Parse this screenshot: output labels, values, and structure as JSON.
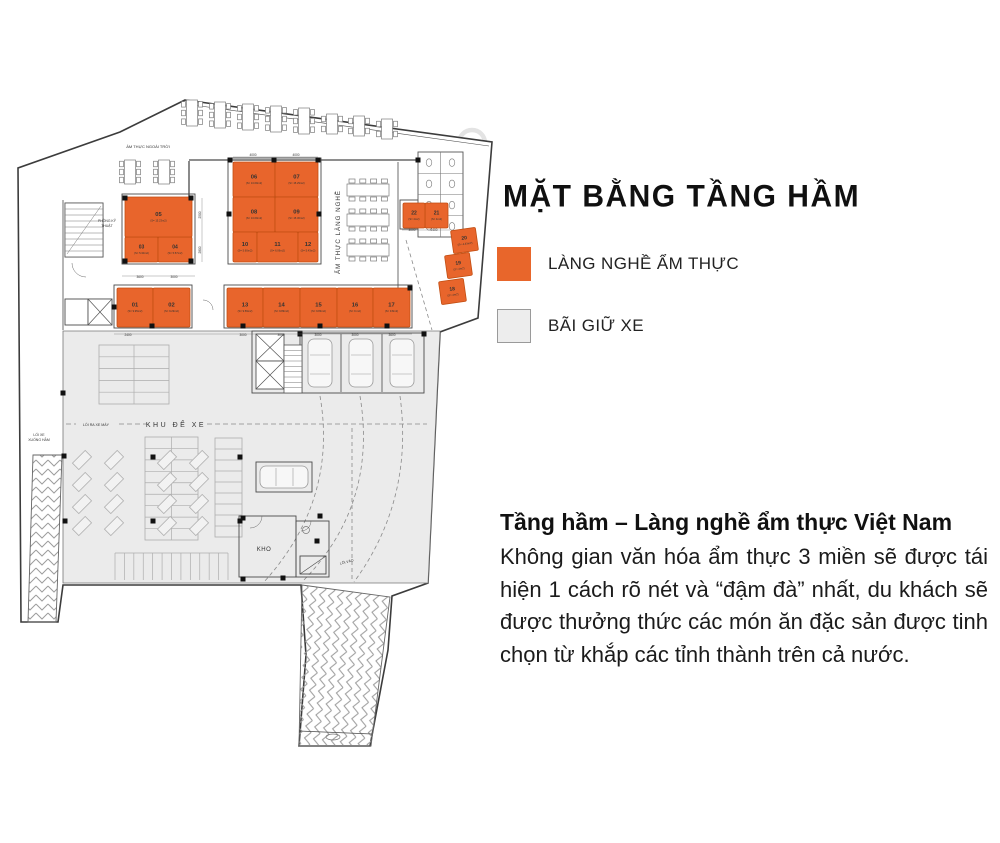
{
  "title": "MẶT BẰNG TẦNG HẦM",
  "legend": {
    "items": [
      {
        "label": "LÀNG NGHỀ ẨM THỰC",
        "color": "#E8662B",
        "border": "#E8662B"
      },
      {
        "label": "BÃI GIỮ XE",
        "color": "#EDEDED",
        "border": "#9A9A9A"
      }
    ]
  },
  "description": {
    "heading": "Tầng hầm – Làng nghề ẩm thực Việt Nam",
    "body": "Không gian văn hóa ẩm thực 3 miền sẽ được tái hiện 1 cách rõ nét và “đậm đà” nhất, du khách sẽ được thưởng thức các món ăn đặc sản được tinh chọn từ khắp các tỉnh thành trên cả nước."
  },
  "plan": {
    "colors": {
      "unit": "#E8652C",
      "unitBorder": "#C24E12",
      "unitText": "#3d1500",
      "parking": "#EBEBEB",
      "line": "#3c3c3c",
      "thin": "#7d7d7d",
      "grid": "#ADADAD",
      "dash": "#8a8a8a",
      "watermark": "#E3E3E3"
    },
    "outline": "185,100 492,142 478,318 440,332 428,583 392,596 388,650 370,746 299,746 306,655 301,585 63,585 58,622 21,622 18,168 120,132",
    "parking": "63,331 440,331 428,583 63,583",
    "ramps": [
      {
        "name": "ramp-down-left",
        "pts": "33,455 62,455 56,622 28,622",
        "pattern": "chevV"
      },
      {
        "name": "ramp-entrance",
        "pts": "302,585 390,597 371,746 299,746",
        "pattern": "chevR"
      }
    ],
    "watermarks": [
      [
        472,
        143,
        13
      ],
      [
        590,
        131,
        13
      ]
    ],
    "lines": [
      [
        186,
        104,
        489,
        146,
        0.6
      ],
      [
        189,
        160,
        418,
        160,
        1.3
      ],
      [
        189,
        161,
        189,
        197,
        1.3
      ],
      [
        398,
        162,
        398,
        288,
        0.8
      ],
      [
        63,
        200,
        63,
        330,
        0.8
      ],
      [
        341,
        334,
        341,
        392,
        0.8
      ],
      [
        382,
        334,
        382,
        392,
        0.8
      ],
      [
        299,
        731,
        372,
        734,
        0.8
      ],
      [
        300,
        574,
        326,
        556,
        0.6
      ]
    ],
    "segline": {
      "y": 424,
      "segs": [
        [
          66,
          76
        ],
        [
          119,
          147
        ],
        [
          207,
          427
        ]
      ]
    },
    "grids": [
      {
        "x": 99,
        "y": 345,
        "w": 70,
        "h": 59,
        "rows": 5,
        "cols": 2
      },
      {
        "x": 145,
        "y": 437,
        "w": 53,
        "h": 103,
        "rows": 9,
        "cols": 2
      },
      {
        "x": 215,
        "y": 438,
        "w": 27,
        "h": 99,
        "rows": 9,
        "cols": 1
      },
      {
        "x": 115,
        "y": 553,
        "w": 113,
        "h": 27,
        "comb": 12
      }
    ],
    "diamond_xs": [
      82,
      114,
      167,
      199
    ],
    "diamond_ys": [
      460,
      482,
      504,
      526
    ],
    "dashes": [
      "M352,428 L352,582",
      "M320,396 Q338,500 264,582",
      "M360,396 Q378,505 302,582",
      "M400,396 Q414,500 354,582",
      "M406,240 L432,330"
    ],
    "rooms": [
      {
        "x": 122,
        "y": 194,
        "w": 73,
        "h": 70
      },
      {
        "x": 228,
        "y": 158,
        "w": 93,
        "h": 106
      },
      {
        "x": 114,
        "y": 285,
        "w": 78,
        "h": 43
      },
      {
        "x": 224,
        "y": 285,
        "w": 188,
        "h": 43
      },
      {
        "x": 400,
        "y": 200,
        "w": 50,
        "h": 29
      },
      {
        "x": 252,
        "y": 331,
        "w": 50,
        "h": 62
      },
      {
        "x": 239,
        "y": 516,
        "w": 57,
        "h": 61
      },
      {
        "x": 296,
        "y": 521,
        "w": 33,
        "h": 56
      },
      {
        "x": 65,
        "y": 203,
        "w": 38,
        "h": 54
      },
      {
        "x": 65,
        "y": 299,
        "w": 23,
        "h": 26
      },
      {
        "x": 88,
        "y": 299,
        "w": 24,
        "h": 26
      },
      {
        "x": 300,
        "y": 333,
        "w": 124,
        "h": 60
      },
      {
        "x": 256,
        "y": 462,
        "w": 56,
        "h": 30
      },
      {
        "x": 300,
        "y": 556,
        "w": 26,
        "h": 18
      }
    ],
    "elevators": [
      {
        "x": 88,
        "y": 299,
        "w": 24,
        "h": 26
      },
      {
        "x": 256,
        "y": 334,
        "w": 28,
        "h": 27
      },
      {
        "x": 256,
        "y": 361,
        "w": 28,
        "h": 28
      }
    ],
    "stairs": [
      {
        "x": 65,
        "y": 203,
        "w": 38,
        "h": 54,
        "n": 9,
        "diag": 1
      },
      {
        "x": 284,
        "y": 345,
        "w": 18,
        "h": 48,
        "n": 9
      }
    ],
    "cars": [
      {
        "x": 320,
        "y": 363
      },
      {
        "x": 361,
        "y": 363
      },
      {
        "x": 402,
        "y": 363
      },
      {
        "x": 284,
        "y": 477,
        "o": "h"
      }
    ],
    "tables": [
      {
        "x": 192,
        "y": 113
      },
      {
        "x": 220,
        "y": 115
      },
      {
        "x": 248,
        "y": 117
      },
      {
        "x": 276,
        "y": 119
      },
      {
        "x": 304,
        "y": 121
      },
      {
        "x": 332,
        "y": 124,
        "hh": 20,
        "n": 2
      },
      {
        "x": 359,
        "y": 126,
        "hh": 20,
        "n": 2
      },
      {
        "x": 387,
        "y": 129,
        "hh": 20,
        "n": 2
      },
      {
        "x": 130,
        "y": 172,
        "hh": 24
      },
      {
        "x": 164,
        "y": 172,
        "hh": 24
      },
      {
        "x": 368,
        "y": 190,
        "o": "h"
      },
      {
        "x": 368,
        "y": 220,
        "o": "h"
      },
      {
        "x": 368,
        "y": 250,
        "o": "h"
      }
    ],
    "wc": {
      "x": 418,
      "y": 152,
      "w": 45,
      "h": 85,
      "rows": 4
    },
    "fixtures": {
      "circles": [
        [
          306,
          530,
          3.5
        ],
        [
          333,
          737,
          7,
          3
        ]
      ]
    },
    "arcs": [
      "M72,263 a14,14 0 0 0 14,14",
      "M262,516 a12,12 0 0 1 -12,12",
      "M203,300 a10,10 0 0 1 10,10",
      "M311,521 a10,10 0 0 1 -10,10"
    ],
    "units": [
      {
        "id": "01",
        "area": "(S= 9.95m2)",
        "x": 117,
        "y": 288,
        "w": 36,
        "h": 39
      },
      {
        "id": "02",
        "area": "(S= 9.29m2)",
        "x": 153,
        "y": 288,
        "w": 37,
        "h": 39
      },
      {
        "id": "03",
        "area": "(S= 5.30m2)",
        "x": 125,
        "y": 237,
        "w": 33,
        "h": 25
      },
      {
        "id": "04",
        "area": "(S= 5.57m2)",
        "x": 158,
        "y": 237,
        "w": 34,
        "h": 25
      },
      {
        "id": "05",
        "area": "(S= 15.23m2)",
        "x": 125,
        "y": 197,
        "w": 67,
        "h": 40
      },
      {
        "id": "06",
        "area": "(S= 13.69m2)",
        "x": 233,
        "y": 162,
        "w": 42,
        "h": 35
      },
      {
        "id": "07",
        "area": "(S= 15.29m2)",
        "x": 275,
        "y": 162,
        "w": 43,
        "h": 35
      },
      {
        "id": "08",
        "area": "(S= 13.69m2)",
        "x": 233,
        "y": 197,
        "w": 42,
        "h": 35
      },
      {
        "id": "09",
        "area": "(S= 15.30m2)",
        "x": 275,
        "y": 197,
        "w": 43,
        "h": 35
      },
      {
        "id": "10",
        "area": "(S= 5.60m2)",
        "x": 233,
        "y": 232,
        "w": 24,
        "h": 30
      },
      {
        "id": "11",
        "area": "(S= 6.06m2)",
        "x": 257,
        "y": 232,
        "w": 41,
        "h": 30
      },
      {
        "id": "12",
        "area": "(S= 5.43m2)",
        "x": 298,
        "y": 232,
        "w": 20,
        "h": 30
      },
      {
        "id": "13",
        "area": "(S= 9.59m2)",
        "x": 227,
        "y": 288,
        "w": 36,
        "h": 39
      },
      {
        "id": "14",
        "area": "(S= 9.89m2)",
        "x": 263,
        "y": 288,
        "w": 37,
        "h": 39
      },
      {
        "id": "15",
        "area": "(S= 9.83m2)",
        "x": 300,
        "y": 288,
        "w": 37,
        "h": 39
      },
      {
        "id": "16",
        "area": "(S= 9 m2)",
        "x": 337,
        "y": 288,
        "w": 36,
        "h": 39
      },
      {
        "id": "17",
        "area": "(S= 9.8m2)",
        "x": 373,
        "y": 288,
        "w": 37,
        "h": 39
      },
      {
        "id": "18",
        "area": "(S= 4m2)",
        "x": 440,
        "y": 280,
        "w": 25,
        "h": 23,
        "rot": -8
      },
      {
        "id": "19",
        "area": "(S= 4m2)",
        "x": 446,
        "y": 254,
        "w": 25,
        "h": 23,
        "rot": -8
      },
      {
        "id": "20",
        "area": "(S= 4.43m2)",
        "x": 452,
        "y": 229,
        "w": 25,
        "h": 23,
        "rot": -8
      },
      {
        "id": "21",
        "area": "(S= 4m2)",
        "x": 425,
        "y": 203,
        "w": 23,
        "h": 25
      },
      {
        "id": "22",
        "area": "(S= 4m2)",
        "x": 403,
        "y": 203,
        "w": 22,
        "h": 25
      }
    ],
    "labels": [
      {
        "t": "ẨM THỰC NGOÀI TRỜI",
        "x": 148,
        "y": 148,
        "s": 4
      },
      {
        "t": "PHÒNG KỸ",
        "x": 107,
        "y": 222,
        "s": 3.4
      },
      {
        "t": "THUẬT",
        "x": 107,
        "y": 227,
        "s": 3.4
      },
      {
        "t": "ẨM THỰC LÀNG NGHỀ",
        "x": 340,
        "y": 232,
        "s": 6.2,
        "r": -90,
        "ls": 1
      },
      {
        "t": "KHU ĐỂ XE",
        "x": 176,
        "y": 427,
        "s": 7,
        "ls": 2.5
      },
      {
        "t": "LỐI RA XE MÁY",
        "x": 96,
        "y": 426,
        "s": 3.6
      },
      {
        "t": "LỐI XE",
        "x": 39,
        "y": 436,
        "s": 3.5
      },
      {
        "t": "XUỐNG HẦM",
        "x": 39,
        "y": 441,
        "s": 3.5
      },
      {
        "t": "KHO",
        "x": 264,
        "y": 551,
        "s": 6,
        "ls": 0.5
      },
      {
        "t": "LỐI VÀO",
        "x": 347,
        "y": 563,
        "s": 3.5,
        "r": -15
      }
    ],
    "dims": [
      [
        "4000",
        253,
        156
      ],
      [
        "4000",
        296,
        156
      ],
      [
        "3600",
        140,
        278
      ],
      [
        "3000",
        174,
        278
      ],
      [
        "3000",
        412,
        231
      ],
      [
        "2400",
        434,
        231
      ],
      [
        "2400",
        128,
        336
      ],
      [
        "3000",
        243,
        336
      ],
      [
        "3000",
        281,
        336
      ],
      [
        "3000",
        318,
        336
      ],
      [
        "3000",
        355,
        336
      ],
      [
        "3600",
        392,
        336
      ],
      [
        "2500",
        201,
        215,
        -90
      ],
      [
        "2800",
        201,
        250,
        -90
      ]
    ],
    "dimLines": [
      [
        233,
        157,
        318,
        157
      ],
      [
        122,
        276,
        195,
        276
      ],
      [
        402,
        230,
        450,
        230
      ],
      [
        114,
        334,
        412,
        334
      ],
      [
        202,
        198,
        202,
        262
      ]
    ],
    "columns": [
      [
        230,
        160
      ],
      [
        274,
        160
      ],
      [
        318,
        160
      ],
      [
        229,
        214
      ],
      [
        319,
        214
      ],
      [
        125,
        198
      ],
      [
        191,
        198
      ],
      [
        125,
        261
      ],
      [
        191,
        261
      ],
      [
        114,
        307
      ],
      [
        152,
        326
      ],
      [
        243,
        326
      ],
      [
        320,
        326
      ],
      [
        387,
        326
      ],
      [
        410,
        288
      ],
      [
        63,
        393
      ],
      [
        64,
        456
      ],
      [
        65,
        521
      ],
      [
        153,
        457
      ],
      [
        153,
        521
      ],
      [
        240,
        457
      ],
      [
        240,
        521
      ],
      [
        320,
        516
      ],
      [
        317,
        541
      ],
      [
        283,
        578
      ],
      [
        243,
        579
      ],
      [
        243,
        518
      ],
      [
        300,
        334
      ],
      [
        424,
        334
      ],
      [
        418,
        160
      ]
    ]
  }
}
